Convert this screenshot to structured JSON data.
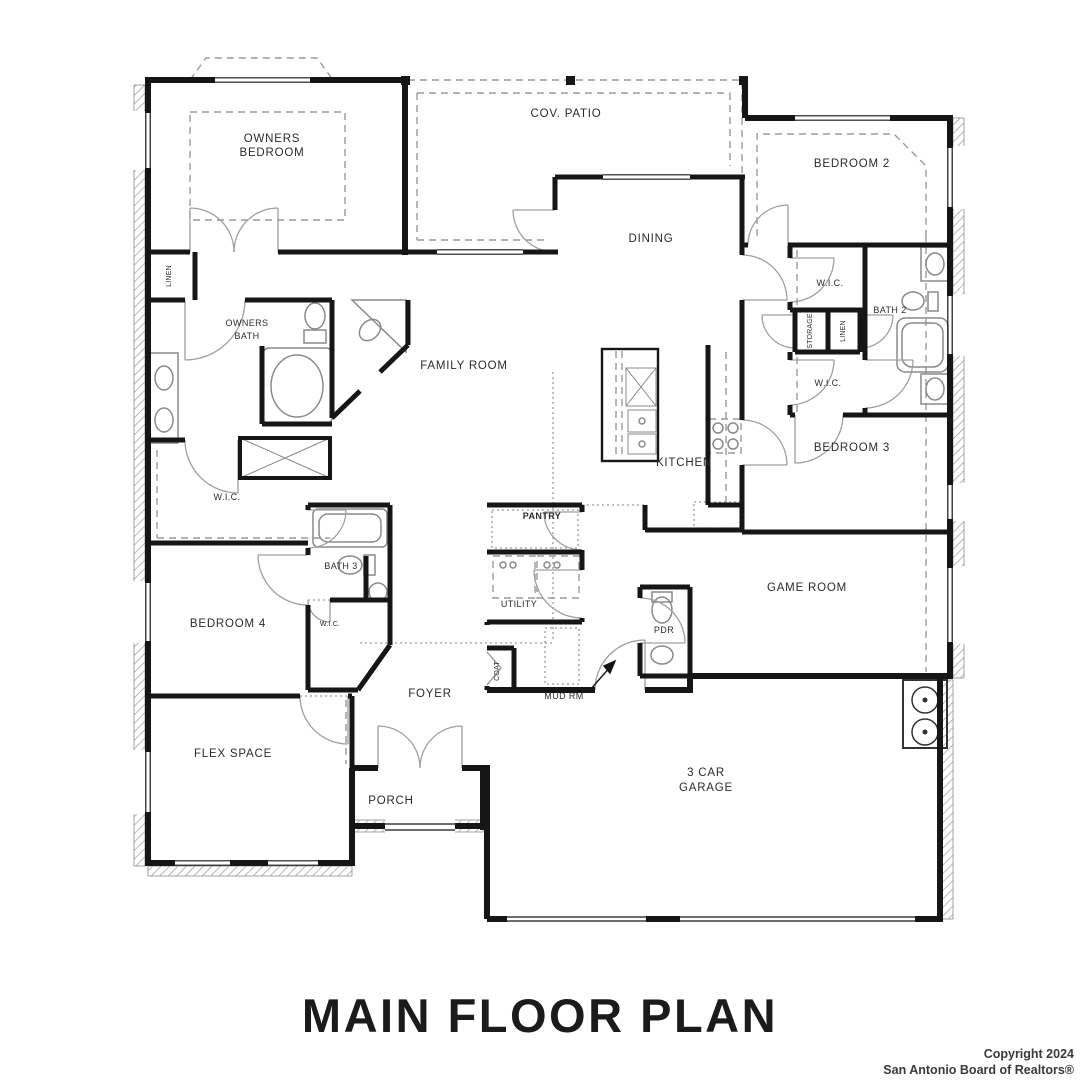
{
  "title": "MAIN FLOOR PLAN",
  "copyright": {
    "line1": "Copyright 2024",
    "line2": "San Antonio Board of Realtors®"
  },
  "plan_type": "residential-main-floor-plan",
  "rooms": {
    "owners_bedroom_l1": "OWNERS",
    "owners_bedroom_l2": "BEDROOM",
    "cov_patio": "COV. PATIO",
    "bedroom2": "BEDROOM 2",
    "dining": "DINING",
    "wic_bedroom2_upper": "W.I.C.",
    "bath2": "BATH 2",
    "storage": "STORAGE",
    "linen_bath2": "LINEN",
    "wic_bedroom2_lower": "W.I.C.",
    "linen_owners": "LINEN",
    "owners_bath_l1": "OWNERS",
    "owners_bath_l2": "BATH",
    "family_room": "FAMILY ROOM",
    "kitchen": "KITCHEN",
    "bedroom3": "BEDROOM 3",
    "wic_owners": "W.I.C.",
    "pantry": "PANTRY",
    "bath3": "BATH 3",
    "utility": "UTILITY",
    "game_room": "GAME ROOM",
    "wic_bedroom4": "W.I.C.",
    "pdr": "PDR",
    "bedroom4": "BEDROOM 4",
    "coat": "COAT",
    "foyer": "FOYER",
    "mud_rm": "MUD RM",
    "flex_space": "FLEX SPACE",
    "porch": "PORCH",
    "garage_l1": "3 CAR",
    "garage_l2": "GARAGE"
  },
  "colors": {
    "wall": "#161616",
    "fixture": "#8a8a8a",
    "dashed_line": "#9a9a9a",
    "label_text": "#2b2b2b",
    "background": "#ffffff"
  }
}
